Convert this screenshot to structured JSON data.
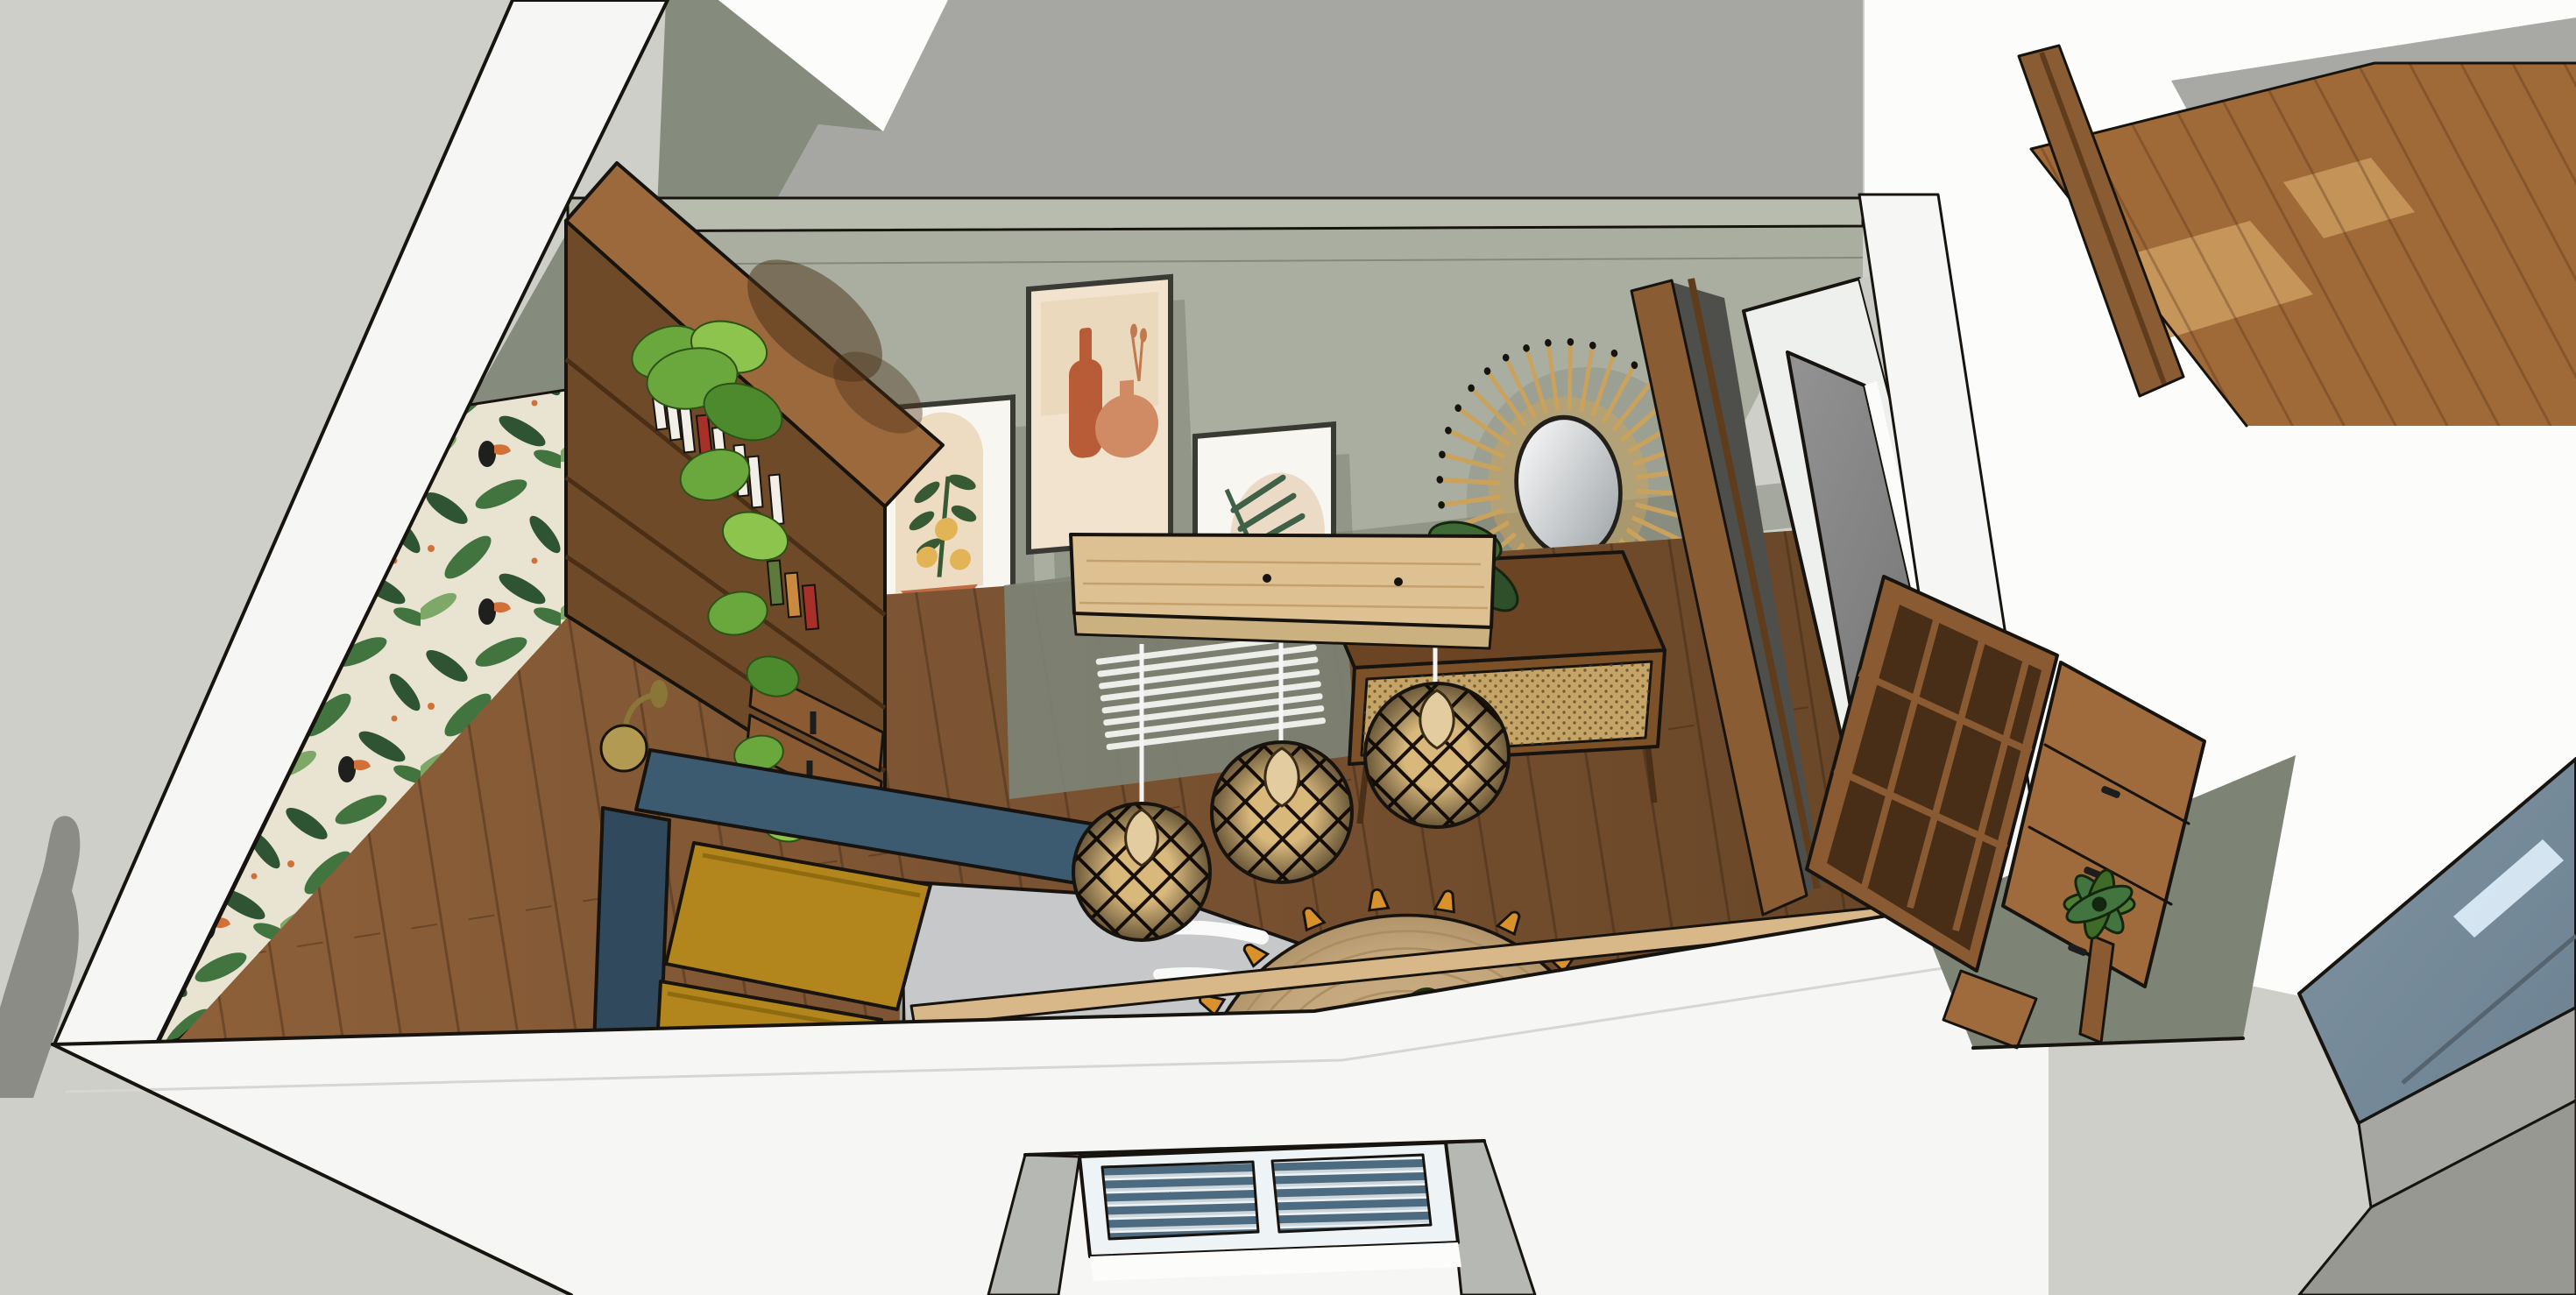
{
  "scene": {
    "title": "3D cutaway interior render of a bedroom-living room, viewed from above (SketchUp-style)",
    "view": "axonometric top-down cutaway, white sectioned walls",
    "rooms": [
      "main bedroom/living room",
      "hallway with wood floor (top right)",
      "entrance with glass canopy (bottom right)"
    ]
  },
  "objects": [
    {
      "id": "person-shadow",
      "label": "shadow of a standing person on the ground, bottom left"
    },
    {
      "id": "left-wall-cut",
      "label": "white cut wall band, left"
    },
    {
      "id": "front-wall-cut",
      "label": "white cut wall band, bottom foreground"
    },
    {
      "id": "wallpaper-wall",
      "label": "tropical jungle wallpaper with toucans"
    },
    {
      "id": "back-wall",
      "label": "sage green gallery wall"
    },
    {
      "id": "art-frame-botanical",
      "label": "framed botanical print with lemons and terracotta bowl"
    },
    {
      "id": "art-frame-vases",
      "label": "framed terracotta vases print"
    },
    {
      "id": "art-frame-palm",
      "label": "framed palm leaf print"
    },
    {
      "id": "sunburst-mirror",
      "label": "rattan sunburst mirror"
    },
    {
      "id": "bookshelf",
      "label": "tall wooden bookshelf with books and drawers"
    },
    {
      "id": "wall-sconce",
      "label": "brass wall sconce"
    },
    {
      "id": "hanging-plant",
      "label": "trailing pothos plant on bookshelf"
    },
    {
      "id": "bed",
      "label": "bed with dark teal headboard, mustard pillows, gray duvet"
    },
    {
      "id": "console-shelf",
      "label": "floating light-wood shelf"
    },
    {
      "id": "pendant-lamps",
      "label": "three rattan lattice pendant lamps",
      "count": 3
    },
    {
      "id": "radiator",
      "label": "white slatted radiator"
    },
    {
      "id": "sideboard",
      "label": "wood sideboard with cane doors"
    },
    {
      "id": "sideboard-plant",
      "label": "dark green potted plant on sideboard"
    },
    {
      "id": "jute-rug",
      "label": "round jute rug with orange tassels"
    },
    {
      "id": "banana-plant",
      "label": "banana-leaf plant near front wall"
    },
    {
      "id": "door-frame",
      "label": "wood door frame to hallway"
    },
    {
      "id": "tv-partition",
      "label": "white partition wall with flat TV"
    },
    {
      "id": "cubby-bookcase",
      "label": "open wood cubby shelf unit"
    },
    {
      "id": "drawer-cabinet",
      "label": "wood cabinet with drawers and black handles"
    },
    {
      "id": "potted-plant-right",
      "label": "potted plant in right corner"
    },
    {
      "id": "window",
      "label": "recessed window with blue horizontal blinds, bottom center"
    },
    {
      "id": "glass-canopy",
      "label": "blue glass canopy over entrance, bottom right"
    },
    {
      "id": "hallway-floor",
      "label": "sunlit wood floor of adjacent hallway"
    }
  ],
  "colors": {
    "outline": "#17130e",
    "ground": "#cdcfc8",
    "figure-shadow": "#8b8c85",
    "white-wall": "#f6f7f4",
    "white-bright": "#fcfcfa",
    "ceiling-gray": "#a6a7a2",
    "ceiling-dark": "#858c7e",
    "wall-sage": "#a9aea1",
    "wall-sage-band": "#b7bcae",
    "wall-sage-dark": "#7d8375",
    "wall-shadow": "#6d7364",
    "wallpaper-bg": "#e9e4d2",
    "leaf-dark": "#2e5433",
    "leaf-mid": "#41743f",
    "leaf-light": "#71a25b",
    "toucan-black": "#1f1f1d",
    "accent-orange": "#d2703a",
    "floor-wood": "#7c5433",
    "floor-wood-light": "#8d6039",
    "floor-wood-dark": "#684627",
    "plank-line": "rgba(45,25,10,0.32)",
    "hall-wood": "#a06a38",
    "hall-wood-sun": "#c99a5e",
    "hall-shadow": "#a8a8a5",
    "shelf-wood": "#9b693c",
    "shelf-face": "#6f4a28",
    "shelf-face-dark": "#4a2f16",
    "book-white": "#f1efe8",
    "book-red": "#a83028",
    "book-green": "#5d7a3c",
    "book-tan": "#c98a3f",
    "sconce-brass": "#b29a52",
    "plant-green": "#6aa83e",
    "plant-green-light": "#8cc44e",
    "plant-green-dark": "#4d8a2e",
    "plant-outline": "#2c5216",
    "pot-black": "#2e2a26",
    "bed-teal": "#3c5a70",
    "bed-teal-dark": "#31495c",
    "pillow-mustard": "#b2861c",
    "pillow-mustard-dark": "#8f6b10",
    "duvet-gray": "#c6c8c9",
    "sheet-white": "#fdfdfd",
    "console-wood": "#ddc193",
    "console-grain": "#c4a06c",
    "cord-white": "#f5f5f5",
    "pendant-tan": "#d9b87c",
    "pendant-black": "#181008",
    "cone-wood": "#e3cda0",
    "radiator-white": "#eceeea",
    "sideboard-top": "#6b4423",
    "sideboard-front": "#7d5128",
    "cane": "#c5a468",
    "cane-dot": "#5f4220",
    "rug-jute": "#c3a67c",
    "rug-ring": "#a9895d",
    "tassel": "#d9912b",
    "banana-green": "#4e7d33",
    "banana-dark": "#3f6b28",
    "banana-vein": "#7fae58",
    "door-wood": "#8a5c33",
    "door-wood-dark": "#5f3c1c",
    "partition-white": "#eef0ee",
    "partition-gray": "#c9cac6",
    "tv-gray": "#939393",
    "tv-gray-dark": "#6f6f6f",
    "cab-wood": "#8a5a33",
    "cab-wood-light": "#a06b3c",
    "cab-dark": "#3c2713",
    "handle-black": "#1d1d1d",
    "blind-dark": "#4d6b80",
    "blind-light": "#cdd6da",
    "window-frame": "#eef3f6",
    "recess-gray": "#b6b8b4",
    "glass-blue": "#7f93a2",
    "glass-blue-deep": "#6c8191",
    "glass-light": "#dff0fb",
    "canopy-gray": "#a6a6a2",
    "canopy-gray2": "#989893",
    "art-cream": "#f1e3cd",
    "art-white": "#f8f6f0",
    "terracotta": "#bf6b43",
    "terracotta-light": "#d08a64",
    "terracotta-deep": "#b85c38",
    "art-yellow": "#e2b456",
    "art-green": "#375a35",
    "palm-green": "#3f6148",
    "mustard-vase": "#b98a3c",
    "mirror-tan": "#caa25c",
    "mirror-glass-dark": "#9aa0a4",
    "sill-tan": "#d8b888"
  }
}
